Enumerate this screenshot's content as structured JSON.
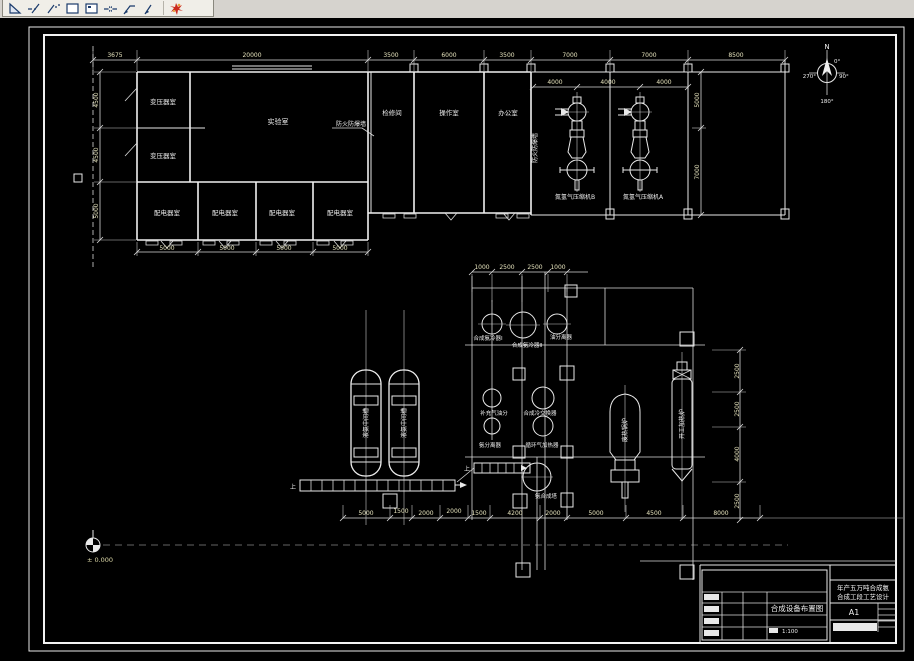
{
  "toolbar": {
    "icons": [
      {
        "name": "triangle-ruler-icon"
      },
      {
        "name": "ray-line-icon"
      },
      {
        "name": "construction-line-icon"
      },
      {
        "name": "rectangle-icon"
      },
      {
        "name": "region-icon"
      },
      {
        "name": "break-dimension-icon"
      },
      {
        "name": "leader-icon"
      },
      {
        "name": "quick-leader-icon"
      },
      {
        "name": "explode-icon"
      }
    ]
  },
  "compass": {
    "north": "N",
    "d0": "0°",
    "d90": "90°",
    "d180": "180°",
    "d270": "270°"
  },
  "plan": {
    "rooms": {
      "transformer1": "变压器室",
      "transformer2": "变压器室",
      "lab": "实验室",
      "maintenance": "检修间",
      "operation": "操作室",
      "office": "办公室",
      "dist1": "配电器室",
      "dist2": "配电器室",
      "dist3": "配电器室",
      "dist4": "配电器室",
      "compressor_b": "氮氢气压缩机B",
      "compressor_a": "氮氢气压缩机A"
    },
    "notes": {
      "firewall_leader": "防火防爆墙",
      "firewall_wall": "防火防爆墙"
    },
    "dims": {
      "top": [
        "3675",
        "20000",
        "3500",
        "6000",
        "3500",
        "7000",
        "7000",
        "8500"
      ],
      "left": [
        "4500",
        "4500",
        "5000"
      ],
      "bottom": [
        "5000",
        "5000",
        "5000",
        "5000"
      ],
      "bay": [
        "4000",
        "4000",
        "4000"
      ],
      "bay_right": [
        "5000",
        "7000"
      ]
    }
  },
  "equipment": {
    "labels": {
      "tank1": "液氨中间槽",
      "tank2": "液氨中间槽",
      "cooler1": "合成氨冷器Ⅰ",
      "cooler2": "合成氨冷器Ⅱ",
      "oil_sep": "油分离器",
      "makeup_sep": "补充气油分",
      "cold_exch": "合成冷交换器",
      "ammonia_sep": "氨分离器",
      "recirc_heater": "循环气加热器",
      "synth_tower": "氨合成塔",
      "waste_boiler": "废热锅炉",
      "startup_heater": "开工加热炉",
      "up1": "上",
      "up2": "上"
    },
    "dims": {
      "top": [
        "1000",
        "2500",
        "2500",
        "1000"
      ],
      "bottom": [
        "5000",
        "1500",
        "2000",
        "2000",
        "1500",
        "4200",
        "2000",
        "5000",
        "4500",
        "8000"
      ],
      "right": [
        "2500",
        "2500",
        "4000",
        "2500"
      ]
    }
  },
  "datum": {
    "elevation": "± 0.000"
  },
  "titleblock": {
    "project_line1": "年产五万吨合成氨",
    "project_line2": "合成工段工艺设计",
    "drawing_name": "合成设备布置图",
    "sheet_size": "A1",
    "scale_value": "1:100"
  }
}
